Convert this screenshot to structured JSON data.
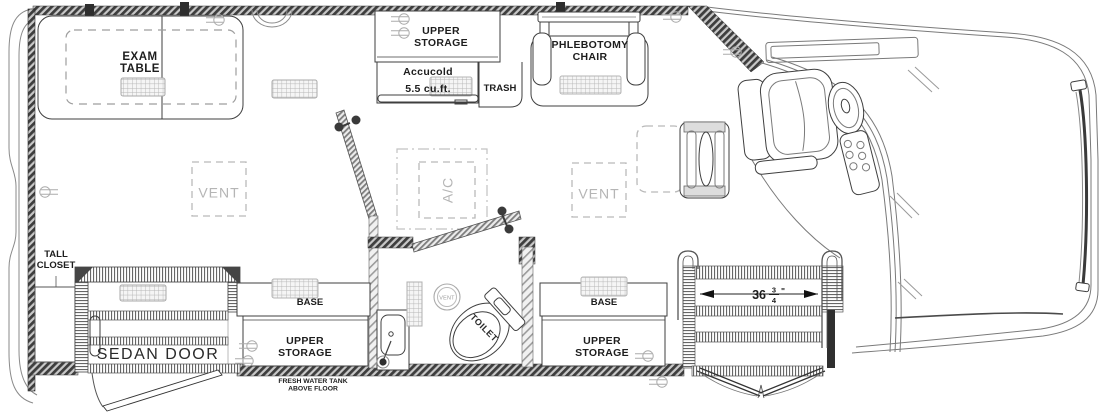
{
  "colors": {
    "wall_hatch": "#3e3e3e",
    "ink": "#1d1d1d",
    "muted_label": "#b5b5b5",
    "grill_fill": "#f5f5f5"
  },
  "exam_area": {
    "table_line1": "EXAM",
    "table_line2": "TABLE",
    "vent": "VENT"
  },
  "galley": {
    "upper_line1": "UPPER",
    "upper_line2": "STORAGE",
    "fridge_brand": "Accucold",
    "fridge_size": "5.5 cu.ft.",
    "trash": "TRASH"
  },
  "phlebotomy": {
    "line1": "PHLEBOTOMY",
    "line2": "CHAIR"
  },
  "hvac": {
    "ac": "A/C",
    "vent_mid": "VENT"
  },
  "bathroom": {
    "toilet": "TOILET",
    "fan": "VENT"
  },
  "entry_curb": {
    "tall_closet_line1": "TALL",
    "tall_closet_line2": "CLOSET",
    "sedan_door": "SEDAN DOOR"
  },
  "cabinets_left": {
    "base": "BASE",
    "upper_line1": "UPPER",
    "upper_line2": "STORAGE"
  },
  "cabinets_right": {
    "base": "BASE",
    "upper_line1": "UPPER",
    "upper_line2": "STORAGE"
  },
  "entry_door": {
    "width_whole": "36",
    "width_num": "3",
    "width_den": "4",
    "width_unit": "\""
  },
  "notes": {
    "fresh_water_line1": "FRESH WATER TANK",
    "fresh_water_line2": "ABOVE FLOOR"
  }
}
